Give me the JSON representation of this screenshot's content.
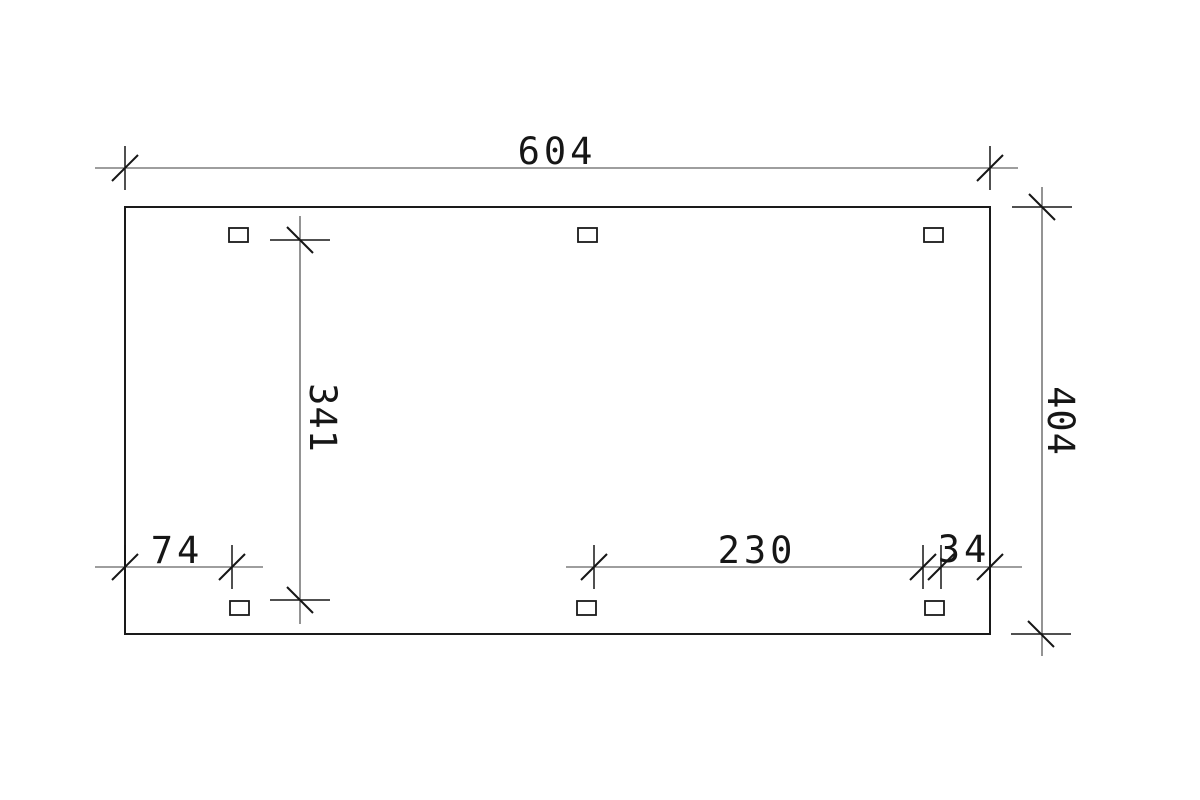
{
  "document": {
    "type": "technical-dimension-drawing",
    "view": "top-view-plan",
    "background": "#ffffff"
  },
  "dimensions": {
    "top_width": "604",
    "right_depth": "404",
    "inner_depth": "341",
    "bottom_left_span": "74",
    "bottom_mid_span": "230",
    "bottom_right_span": "34"
  },
  "posts": {
    "count": 6,
    "marker": "square-outline"
  },
  "colors": {
    "outline": "#1a1a1a",
    "dimension_line": "#3d3d3d",
    "text": "#161616"
  }
}
